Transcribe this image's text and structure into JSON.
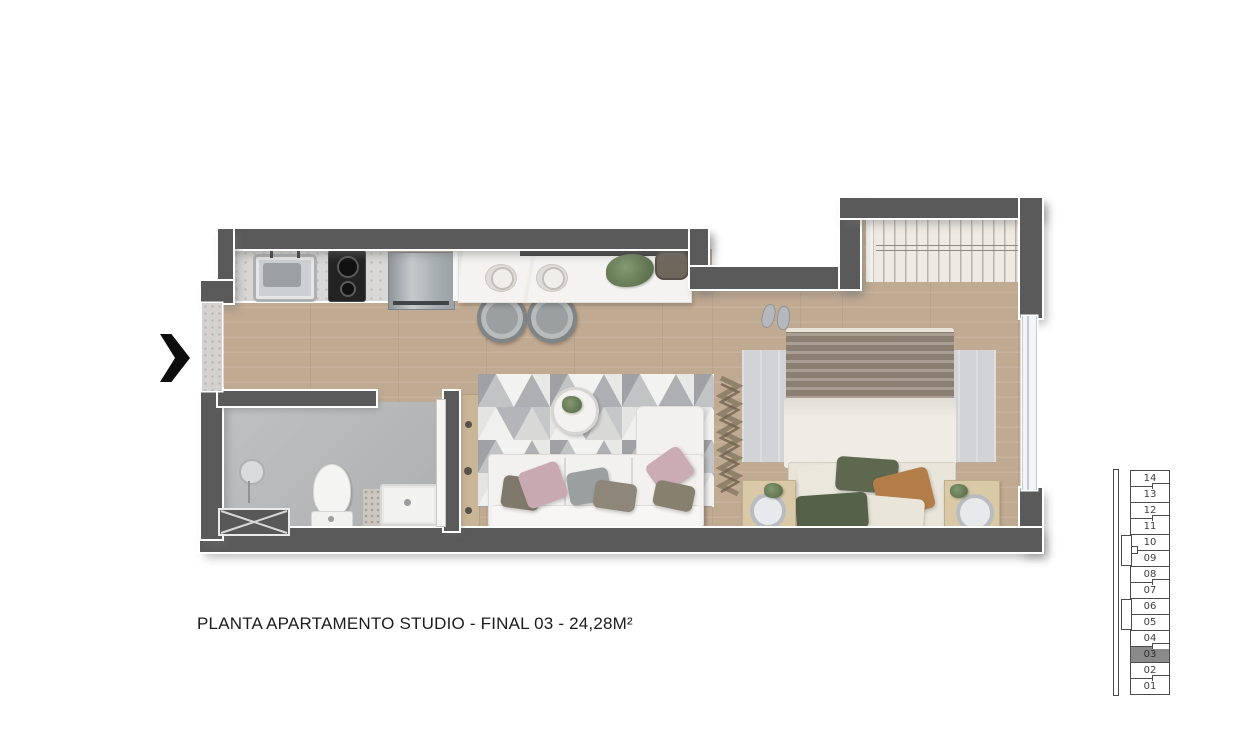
{
  "caption": {
    "text": "PLANTA APARTAMENTO STUDIO - FINAL 03 - 24,28M²"
  },
  "floorplan": {
    "type": "studio-apartment-top-view",
    "elements": [
      "kitchen-sink",
      "stove-cooktop",
      "refrigerator",
      "bar-counter",
      "place-settings",
      "bar-stools",
      "plant",
      "tray",
      "area-rug",
      "coffee-table",
      "sofa",
      "pillows",
      "decor-zigzag-ladder",
      "wardrobe-closet",
      "bed",
      "bed-rug",
      "slippers",
      "nightstands",
      "shower-head",
      "floor-drain",
      "toilet",
      "bathroom-vanity-sink",
      "bath-mat",
      "entry-opening",
      "window"
    ],
    "entry_arrow_direction": "right"
  },
  "stack": {
    "floors": [
      {
        "label": "14"
      },
      {
        "label": "13"
      },
      {
        "label": "12"
      },
      {
        "label": "11"
      },
      {
        "label": "10"
      },
      {
        "label": "09"
      },
      {
        "label": "08"
      },
      {
        "label": "07"
      },
      {
        "label": "06"
      },
      {
        "label": "05"
      },
      {
        "label": "04"
      },
      {
        "label": "03"
      },
      {
        "label": "02"
      },
      {
        "label": "01"
      }
    ],
    "highlighted_floor": "03"
  },
  "colors": {
    "wall": "#5a5a5a",
    "wood_floor": "#c1aa92",
    "bath_floor": "#b6b8ba",
    "kitchen_counter": "#d8d7d5",
    "bar_counter": "#f4f3f1",
    "highlighted_cell": "#8a8a8a",
    "arrow": "#0d0d0d"
  }
}
